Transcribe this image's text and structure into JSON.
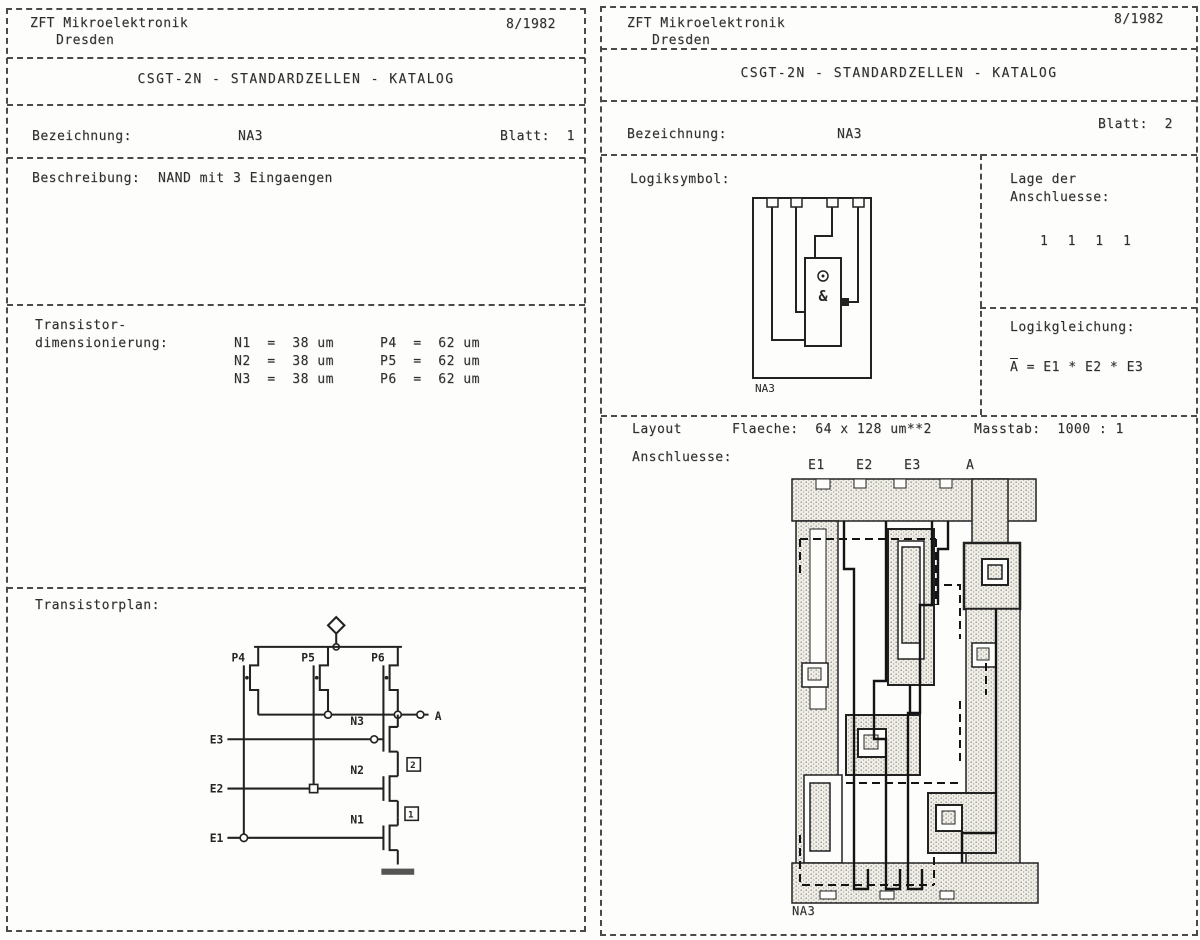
{
  "doc": {
    "org_line1": "ZFT Mikroelektronik",
    "org_line2": "Dresden",
    "date": "8/1982",
    "title": "CSGT-2N - STANDARDZELLEN - KATALOG",
    "bezeichnung_label": "Bezeichnung:",
    "cell_name": "NA3",
    "blatt_label_1": "Blatt:  1",
    "blatt_label_2": "Blatt:  2"
  },
  "page1": {
    "beschreibung_label": "Beschreibung:",
    "beschreibung_value": "NAND mit 3 Eingaengen",
    "dim_label_line1": "Transistor-",
    "dim_label_line2": "dimensionierung:",
    "dims": [
      {
        "n": "N1  =  38 um",
        "p": "P4  =  62 um"
      },
      {
        "n": "N2  =  38 um",
        "p": "P5  =  62 um"
      },
      {
        "n": "N3  =  38 um",
        "p": "P6  =  62 um"
      }
    ],
    "plan_label": "Transistorplan:",
    "schematic": {
      "p_labels": [
        "P4",
        "P5",
        "P6"
      ],
      "n_labels": [
        "N3",
        "N2",
        "N1"
      ],
      "node_labels": [
        "2",
        "1"
      ],
      "e_labels": [
        "E3",
        "E2",
        "E1"
      ],
      "output_label": "A"
    }
  },
  "page2": {
    "logiksymbol_label": "Logiksymbol:",
    "symbol_gate": "&",
    "symbol_cell_name": "NA3",
    "lage_label_line1": "Lage der",
    "lage_label_line2": "Anschluesse:",
    "lage_values": "1 1 1 1",
    "gleichung_label": "Logikgleichung:",
    "gleichung_lhs": "A",
    "gleichung_rest": " = E1 * E2 * E3",
    "layout_label": "Layout",
    "flaeche": "Flaeche:  64 x 128 um**2",
    "masstab": "Masstab:  1000 : 1",
    "anschluesse_label": "Anschluesse:",
    "pad_labels": [
      "E1",
      "E2",
      "E3",
      "A"
    ],
    "layout_cell_name": "NA3"
  }
}
